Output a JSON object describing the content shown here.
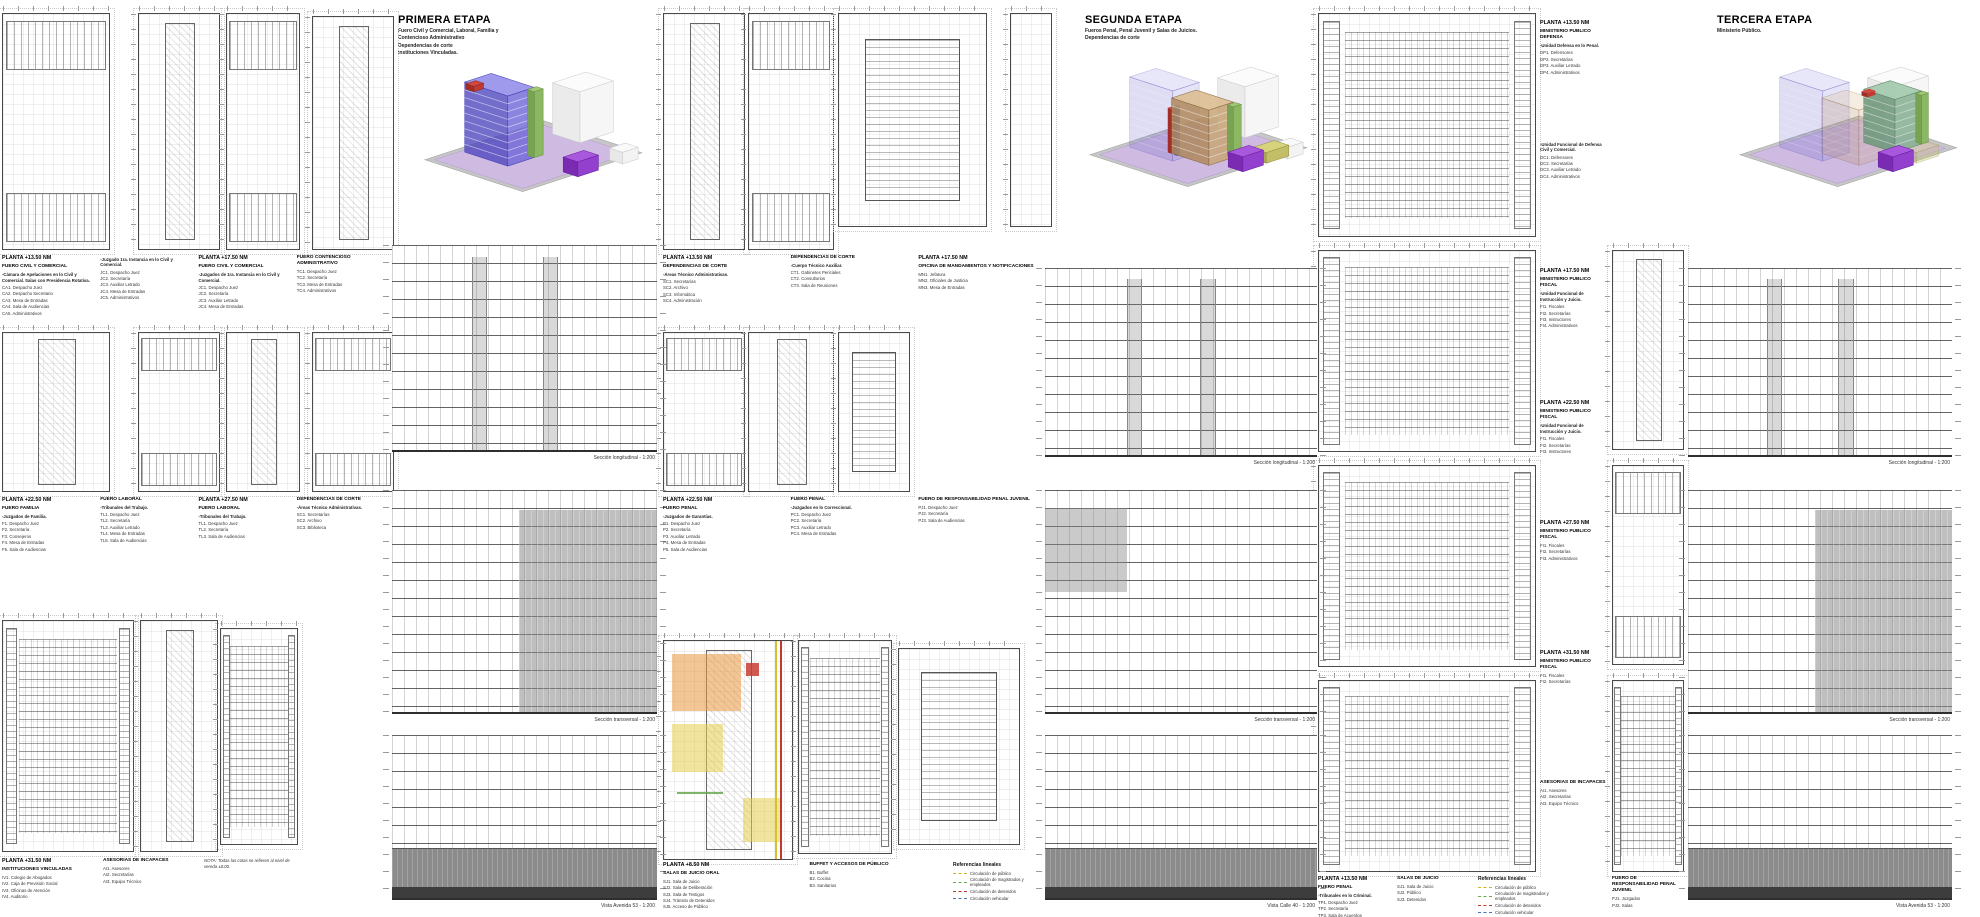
{
  "sheet": {
    "width": 1980,
    "height": 917,
    "background": "#ffffff"
  },
  "stages": [
    {
      "title": "PRIMERA ETAPA",
      "subtitle": "Fuero Civil y Comercial, Laboral, Familia y\nContencioso Administrativo\nDependencias de corte\nInstituciones Vinculadas."
    },
    {
      "title": "SEGUNDA ETAPA",
      "subtitle": "Fueros Penal, Penal Juvenil y Salas de Juicios.\nDependencias de corte"
    },
    {
      "title": "TERCERA ETAPA",
      "subtitle": "Ministerio Público."
    }
  ],
  "colors": {
    "site_purple": "#cfbbe2",
    "plinth_gray": "#c6c6c6",
    "tower_blue": "#6b63d7",
    "tower_tan": "#c8a476",
    "tower_teal": "#88b294",
    "core_green": "#8db863",
    "accent_red": "#bf3a32",
    "accent_purple": "#9240cd",
    "highlight_orange": "rgba(233,151,63,0.55)",
    "highlight_yellow": "rgba(227,205,78,0.55)",
    "highlight_red": "rgba(200,60,50,0.85)",
    "highlight_green": "rgba(106,168,79,0.85)"
  },
  "plans": [
    [
      2,
      13,
      106,
      235,
      "offices"
    ],
    [
      138,
      13,
      80,
      235,
      "core"
    ],
    [
      226,
      13,
      72,
      235,
      "offices"
    ],
    [
      312,
      16,
      80,
      232,
      "core"
    ],
    [
      2,
      332,
      106,
      158,
      "core"
    ],
    [
      138,
      332,
      80,
      158,
      "offices"
    ],
    [
      226,
      332,
      72,
      158,
      "core"
    ],
    [
      312,
      332,
      80,
      158,
      "offices"
    ],
    [
      2,
      620,
      130,
      230,
      "desks"
    ],
    [
      140,
      620,
      76,
      230,
      "core"
    ],
    [
      220,
      628,
      76,
      215,
      "desks"
    ],
    [
      663,
      13,
      80,
      235,
      "core"
    ],
    [
      748,
      13,
      84,
      235,
      "offices"
    ],
    [
      838,
      13,
      147,
      212,
      "hall"
    ],
    [
      1010,
      13,
      40,
      212,
      "slim"
    ],
    [
      663,
      332,
      80,
      158,
      "offices"
    ],
    [
      748,
      332,
      84,
      158,
      "core"
    ],
    [
      838,
      332,
      70,
      158,
      "hall"
    ],
    [
      663,
      640,
      128,
      218,
      "colored"
    ],
    [
      798,
      640,
      92,
      212,
      "desks"
    ],
    [
      898,
      648,
      120,
      195,
      "hall"
    ],
    [
      1318,
      13,
      216,
      222,
      "desks"
    ],
    [
      1318,
      250,
      216,
      200,
      "desks"
    ],
    [
      1318,
      465,
      216,
      200,
      "desks"
    ],
    [
      1318,
      680,
      216,
      190,
      "desks"
    ],
    [
      1612,
      250,
      70,
      198,
      "core"
    ],
    [
      1612,
      465,
      70,
      198,
      "offices"
    ],
    [
      1612,
      680,
      70,
      190,
      "desks"
    ]
  ],
  "elevations": [
    [
      392,
      245,
      265,
      205,
      "section",
      "Sección longitudinal - 1:200"
    ],
    [
      392,
      490,
      265,
      222,
      "half",
      "Sección transversal - 1:200"
    ],
    [
      392,
      735,
      265,
      163,
      "base",
      "Vista Avenida 53 - 1:200"
    ],
    [
      1045,
      268,
      272,
      187,
      "section",
      "Sección longitudinal - 1:200"
    ],
    [
      1045,
      490,
      272,
      222,
      "topband",
      "Sección transversal - 1:200"
    ],
    [
      1045,
      735,
      272,
      163,
      "base",
      "Vista Calle 40 - 1:200"
    ],
    [
      1688,
      268,
      264,
      187,
      "section",
      "Sección longitudinal - 1:200"
    ],
    [
      1688,
      490,
      264,
      222,
      "half",
      "Sección transversal - 1:200"
    ],
    [
      1688,
      735,
      264,
      163,
      "base",
      "Vista Avenida 53 - 1:200"
    ]
  ],
  "caption_rows": [
    {
      "x": 2,
      "y": 255,
      "w": 385,
      "cols": [
        {
          "planta": "PLANTA +13.50 NM",
          "heading": "FUERO CIVIL Y COMERCIAL",
          "sub": "-Cámara de Apelaciones en lo Civil y Comercial. Salas con Presidencia Rotativa.",
          "items": [
            "CA1. Despacho Juez",
            "CA2. Despacho Secretario",
            "CA3. Mesa de Entradas",
            "CA4. Sala de Audiencias",
            "CA5. Administrativos"
          ]
        },
        {
          "sub": "-Juzgado 1ra. Instancia en lo Civil y Comercial.",
          "items": [
            "JC1. Despacho Juez",
            "JC2. Secretaría",
            "JC3. Auxiliar Letrado",
            "JC4. Mesa de Entradas",
            "JC5. Administrativos"
          ]
        },
        {
          "planta": "PLANTA +17.50 NM",
          "heading": "FUERO CIVIL Y COMERCIAL",
          "sub": "-Juzgados de 1ra. Instancia en lo Civil y Comercial.",
          "items": [
            "JC1. Despacho Juez",
            "JC2. Secretaría",
            "JC3. Auxiliar Letrado",
            "JC4. Mesa de Entradas"
          ]
        },
        {
          "heading": "FUERO CONTENCIOSO ADMINISTRATIVO",
          "items": [
            "TC1. Despacho Juez",
            "TC2. Secretaría",
            "TC3. Mesa de Entradas",
            "TC4. Administrativos"
          ]
        }
      ]
    },
    {
      "x": 2,
      "y": 497,
      "w": 385,
      "cols": [
        {
          "planta": "PLANTA +22.50 NM",
          "heading": "FUERO FAMILIA",
          "sub": "-Juzgados de Familia.",
          "items": [
            "F1. Despacho Juez",
            "F2. Secretaría",
            "F3. Consejeros",
            "F4. Mesa de Entradas",
            "F5. Sala de Audiencias"
          ]
        },
        {
          "heading": "FUERO LABORAL",
          "sub": "-Tribunales del Trabajo.",
          "items": [
            "TL1. Despacho Juez",
            "TL2. Secretaría",
            "TL3. Auxiliar Letrado",
            "TL4. Mesa de Entradas",
            "TL5. Sala de Audiencias"
          ]
        },
        {
          "planta": "PLANTA +27.50 NM",
          "heading": "FUERO LABORAL",
          "sub": "-Tribunales del Trabajo.",
          "items": [
            "TL1. Despacho Juez",
            "TL2. Secretaría",
            "TL3. Sala de Audiencias"
          ]
        },
        {
          "heading": "DEPENDENCIAS DE CORTE",
          "sub": "-Áreas Técnico Administrativas.",
          "items": [
            "SC1. Secretarías",
            "SC2. Archivo",
            "SC3. Biblioteca"
          ]
        }
      ]
    },
    {
      "x": 2,
      "y": 858,
      "w": 295,
      "cols": [
        {
          "planta": "PLANTA +31.50 NM",
          "heading": "INSTITUCIONES VINCULADAS",
          "items": [
            "IV1. Colegio de Abogados",
            "IV2. Caja de Previsión Social",
            "IV3. Oficinas de Atención",
            "IV4. Auditorio"
          ]
        },
        {
          "heading": "ASESORIAS DE INCAPACES",
          "items": [
            "AI1. Asesores",
            "AI2. Secretarías",
            "AI3. Equipo Técnico"
          ]
        },
        {
          "note": "NOTA: Todas las cotas se refieren al nivel de vereda ±0.00."
        }
      ]
    },
    {
      "x": 663,
      "y": 255,
      "w": 375,
      "cols": [
        {
          "planta": "PLANTA +13.50 NM",
          "heading": "DEPENDENCIAS DE CORTE",
          "sub": "-Áreas Técnico Administrativas.",
          "items": [
            "SC1. Secretarías",
            "SC2. Archivo",
            "SC3. Informática",
            "SC4. Administración"
          ]
        },
        {
          "heading": "DEPENDENCIAS DE CORTE",
          "sub": "-Cuerpo Técnico Auxiliar.",
          "items": [
            "CT1. Gabinetes Periciales",
            "CT2. Consultorios",
            "CT3. Sala de Reuniones"
          ]
        },
        {
          "planta": "PLANTA +17.50 NM",
          "heading": "OFICINA DE MANDAMIENTOS Y NOTIFICACIONES",
          "items": [
            "MN1. Jefatura",
            "MN2. Oficiales de Justicia",
            "MN3. Mesa de Entradas"
          ]
        }
      ]
    },
    {
      "x": 663,
      "y": 497,
      "w": 375,
      "cols": [
        {
          "planta": "PLANTA +22.50 NM",
          "heading": "FUERO PENAL",
          "sub": "-Juzgados de Garantías.",
          "items": [
            "P1. Despacho Juez",
            "P2. Secretaría",
            "P3. Auxiliar Letrado",
            "P4. Mesa de Entradas",
            "P5. Sala de Audiencias"
          ]
        },
        {
          "heading": "FUERO PENAL",
          "sub": "-Juzgados en lo Correccional.",
          "items": [
            "PC1. Despacho Juez",
            "PC2. Secretaría",
            "PC3. Auxiliar Letrado",
            "PC4. Mesa de Entradas"
          ]
        },
        {
          "heading": "FUERO DE RESPONSABILIDAD PENAL JUVENIL",
          "items": [
            "PJ1. Despacho Juez",
            "PJ2. Secretaría",
            "PJ3. Sala de Audiencias"
          ]
        }
      ]
    },
    {
      "x": 663,
      "y": 862,
      "w": 285,
      "cols": [
        {
          "planta": "PLANTA +8.50 NM",
          "heading": "SALAS DE JUICIO ORAL",
          "items": [
            "SJ1. Sala de Juicio",
            "SJ2. Sala de Deliberación",
            "SJ3. Sala de Testigos",
            "SJ4. Tránsito de Detenidos",
            "SJ5. Acceso de Público"
          ]
        },
        {
          "heading": "BUFFET Y ACCESOS DE PÚBLICO",
          "items": [
            "B1. Buffet",
            "B2. Cocina",
            "B3. Sanitarios"
          ]
        }
      ]
    },
    {
      "x": 1318,
      "y": 876,
      "w": 150,
      "cols": [
        {
          "planta": "PLANTA +13.50 NM",
          "heading": "FUERO PENAL",
          "sub": "-Tribunales en lo Criminal.",
          "items": [
            "TP1. Despacho Juez",
            "TP2. Secretaría",
            "TP3. Sala de Acuerdos"
          ]
        },
        {
          "heading": "SALAS DE JUICIO",
          "items": [
            "SJ1. Sala de Juicio",
            "SJ2. Público",
            "SJ3. Detenidos"
          ]
        }
      ]
    },
    {
      "x": 1540,
      "y": 20,
      "w": 66,
      "cols": [
        {
          "planta": "PLANTA +13.50 NM",
          "heading": "MINISTERIO PUBLICO DEFENSA",
          "sub": "-Unidad Defensa en lo Penal.",
          "items": [
            "DP1. Defensores",
            "DP2. Secretarías",
            "DP3. Auxiliar Letrado",
            "DP4. Administrativos"
          ]
        }
      ]
    },
    {
      "x": 1540,
      "y": 140,
      "w": 66,
      "cols": [
        {
          "sub": "-Unidad Funcional de Defensa Civil y Comercial.",
          "items": [
            "DC1. Defensores",
            "DC2. Secretarías",
            "DC3. Auxiliar Letrado",
            "DC4. Administrativos"
          ]
        }
      ]
    },
    {
      "x": 1540,
      "y": 268,
      "w": 66,
      "cols": [
        {
          "planta": "PLANTA +17.50 NM",
          "heading": "MINISTERIO PUBLICO FISCAL",
          "sub": "-Unidad Funcional de Instrucción y Juicio.",
          "items": [
            "FI1. Fiscales",
            "FI2. Secretarías",
            "FI3. Instructores",
            "FI4. Administrativos"
          ]
        }
      ]
    },
    {
      "x": 1540,
      "y": 400,
      "w": 66,
      "cols": [
        {
          "planta": "PLANTA +22.50 NM",
          "heading": "MINISTERIO PUBLICO FISCAL",
          "sub": "-Unidad Funcional de Instrucción y Juicio.",
          "items": [
            "FI1. Fiscales",
            "FI2. Secretarías",
            "FI3. Instructores"
          ]
        }
      ]
    },
    {
      "x": 1540,
      "y": 520,
      "w": 66,
      "cols": [
        {
          "planta": "PLANTA +27.50 NM",
          "heading": "MINISTERIO PUBLICO FISCAL",
          "items": [
            "FI1. Fiscales",
            "FI2. Secretarías",
            "FI3. Administrativos"
          ]
        }
      ]
    },
    {
      "x": 1540,
      "y": 650,
      "w": 66,
      "cols": [
        {
          "planta": "PLANTA +31.50 NM",
          "heading": "MINISTERIO PUBLICO FISCAL",
          "items": [
            "FI1. Fiscales",
            "FI2. Secretarías"
          ]
        }
      ]
    },
    {
      "x": 1540,
      "y": 780,
      "w": 66,
      "cols": [
        {
          "heading": "ASESORIAS DE INCAPACES",
          "items": [
            "AI1. Asesores",
            "AI2. Secretarías",
            "AI3. Equipo Técnico"
          ]
        }
      ]
    },
    {
      "x": 1612,
      "y": 876,
      "w": 70,
      "cols": [
        {
          "heading": "FUERO DE RESPONSABILIDAD PENAL JUVENIL",
          "items": [
            "PJ1. Juzgados",
            "PJ2. Salas"
          ]
        }
      ]
    }
  ],
  "legend": {
    "title": "Referencias lineales",
    "items": [
      {
        "label": "Circulación de público",
        "color": "#cdb52a"
      },
      {
        "label": "Circulación de magistrados y empleados",
        "color": "#6aa84f"
      },
      {
        "label": "Circulación de detenidos",
        "color": "#c4392e"
      },
      {
        "label": "Circulación vehicular",
        "color": "#4a72b8"
      }
    ],
    "positions": [
      {
        "x": 953,
        "y": 862
      },
      {
        "x": 1478,
        "y": 876
      }
    ]
  },
  "axons": [
    {
      "x": 420,
      "y": 45,
      "w": 235,
      "h": 170,
      "shapes": [
        [
          "t",
          96,
          138,
          122,
          100,
          0,
          "#c6c6c6",
          null,
          null,
          "#9f9f9f"
        ],
        [
          "t",
          96,
          135,
          110,
          90,
          0,
          "#cfbbe2",
          null,
          null,
          "#b39fce"
        ],
        [
          "b",
          150,
          92,
          34,
          28,
          48,
          "#ebebeb",
          "#f6f6f6",
          "#fbfbfb",
          "#cccccc"
        ],
        [
          "b",
          190,
          112,
          16,
          13,
          11,
          "#e8e8e8",
          "#f3f3f3",
          "#f9f9f9",
          "#cccccc"
        ],
        [
          "b",
          148,
          124,
          21,
          15,
          14,
          "#7b2ab2",
          "#9240cd",
          "#a957dc",
          "#661fa0"
        ],
        [
          "b",
          82,
          114,
          27,
          44,
          66,
          "rgba(76,68,188,0.78)",
          "rgba(107,99,215,0.78)",
          "rgba(142,136,232,0.85)",
          "#453db2",
          9,
          "rgba(255,255,255,0.55)"
        ],
        [
          "b",
          107,
          106,
          9,
          7,
          62,
          "#78a352",
          "#8db863",
          "#a2c877",
          "#6a9246"
        ],
        [
          "b",
          50,
          44,
          10,
          8,
          5,
          "#9e2f29",
          "#bf3a32",
          "#d2483e",
          "#8a2823"
        ]
      ]
    },
    {
      "x": 1085,
      "y": 40,
      "w": 235,
      "h": 170,
      "shapes": [
        [
          "t",
          96,
          138,
          122,
          100,
          0,
          "#c6c6c6",
          null,
          null,
          "#9f9f9f"
        ],
        [
          "t",
          96,
          135,
          110,
          90,
          0,
          "#cfbbe2",
          null,
          null,
          "#b39fce"
        ],
        [
          "b",
          150,
          92,
          34,
          28,
          48,
          "#ebebeb",
          "#f6f6f6",
          "#fbfbfb",
          "#cccccc"
        ],
        [
          "b",
          190,
          112,
          16,
          13,
          11,
          "#e8e8e8",
          "#f3f3f3",
          "#f9f9f9",
          "#cccccc"
        ],
        [
          "b",
          82,
          114,
          27,
          44,
          66,
          "rgba(90,84,198,0.20)",
          "rgba(120,114,220,0.20)",
          "rgba(150,145,230,0.22)",
          "rgba(70,62,176,0.35)",
          9,
          "rgba(255,255,255,0.25)"
        ],
        [
          "b",
          81,
          107,
          4,
          4,
          42,
          "#9e2f29",
          "#bf3a32",
          "#d2483e",
          null
        ],
        [
          "b",
          86,
          109,
          3,
          3,
          46,
          "#34539e",
          "#446ab8",
          "#5a7fc9",
          null
        ],
        [
          "b",
          116,
          118,
          25,
          38,
          52,
          "rgba(176,136,92,0.85)",
          "rgba(200,164,118,0.85)",
          "rgba(219,189,146,0.9)",
          "#8a663f",
          7,
          "rgba(255,255,255,0.5)"
        ],
        [
          "b",
          139,
          111,
          8,
          6,
          48,
          "#78a352",
          "#8db863",
          "#a2c877",
          "#6a9246"
        ],
        [
          "b",
          170,
          116,
          23,
          15,
          10,
          "#a8a554",
          "#c2bf68",
          "#d6d37c",
          "#93904a"
        ],
        [
          "b",
          148,
          124,
          21,
          15,
          14,
          "#7b2ab2",
          "#9240cd",
          "#a957dc",
          "#661fa0"
        ]
      ]
    },
    {
      "x": 1735,
      "y": 40,
      "w": 235,
      "h": 170,
      "shapes": [
        [
          "t",
          96,
          138,
          122,
          100,
          0,
          "#c6c6c6",
          null,
          null,
          "#9f9f9f"
        ],
        [
          "t",
          96,
          135,
          110,
          90,
          0,
          "#cfbbe2",
          null,
          null,
          "#b39fce"
        ],
        [
          "b",
          150,
          92,
          34,
          28,
          48,
          "#ebebeb",
          "#f6f6f6",
          "#fbfbfb",
          "#cccccc"
        ],
        [
          "b",
          82,
          114,
          27,
          44,
          66,
          "rgba(90,84,198,0.20)",
          "rgba(120,114,220,0.20)",
          "rgba(150,145,230,0.22)",
          "rgba(70,62,176,0.35)",
          9,
          "rgba(255,255,255,0.25)"
        ],
        [
          "b",
          116,
          118,
          25,
          38,
          52,
          "rgba(176,136,92,0.25)",
          "rgba(200,164,118,0.25)",
          "rgba(219,189,146,0.28)",
          "rgba(138,102,63,0.4)",
          7,
          "rgba(255,255,255,0.2)"
        ],
        [
          "b",
          170,
          116,
          23,
          15,
          10,
          "rgba(168,165,84,0.35)",
          "rgba(194,191,104,0.35)",
          "rgba(214,211,124,0.4)",
          "rgba(147,144,74,0.4)"
        ],
        [
          "b",
          150,
          106,
          27,
          32,
          50,
          "rgba(110,152,124,0.88)",
          "rgba(136,178,148,0.88)",
          "rgba(163,202,174,0.92)",
          "#5c8468",
          7,
          "rgba(255,255,255,0.5)"
        ],
        [
          "b",
          124,
          54,
          8,
          6,
          4,
          "#9e2f29",
          "#bf3a32",
          "#d2483e",
          null
        ],
        [
          "b",
          175,
          98,
          7,
          6,
          46,
          "#78a352",
          "#8db863",
          "#a2c877",
          "#6a9246"
        ],
        [
          "b",
          148,
          124,
          21,
          15,
          14,
          "#7b2ab2",
          "#9240cd",
          "#a957dc",
          "#661fa0"
        ]
      ]
    }
  ]
}
